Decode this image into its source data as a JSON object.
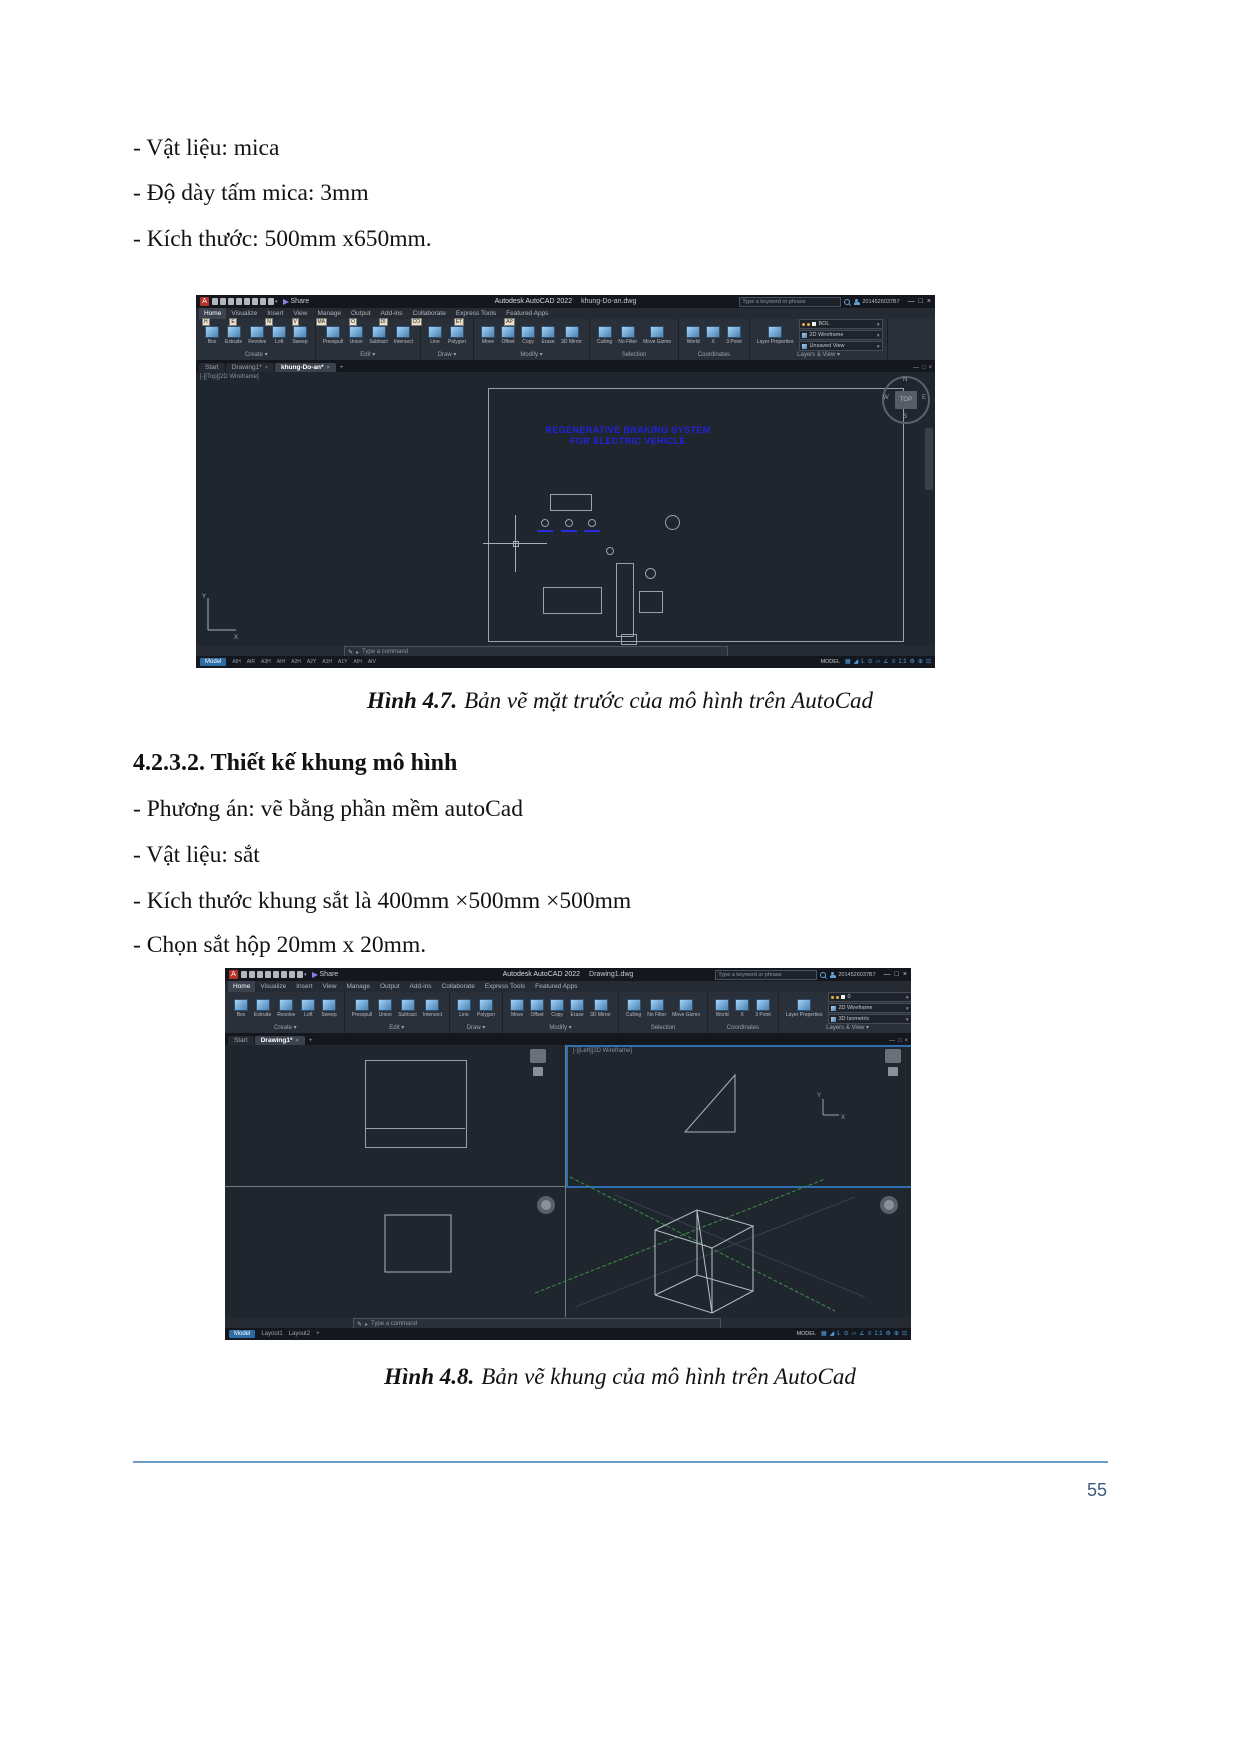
{
  "doc": {
    "bullets_top": [
      "- Vật liệu: mica",
      "- Độ dày tấm mica: 3mm",
      "- Kích thước: 500mm x650mm."
    ],
    "caption1_label": "Hình 4.7.",
    "caption1_text": "Bản vẽ mặt trước của mô hình trên AutoCad",
    "heading": "4.2.3.2. Thiết kế khung mô hình",
    "bullets_mid": [
      "- Phương án: vẽ bằng phần mềm autoCad",
      "- Vật liệu: sắt",
      "- Kích thước khung sắt là 400mm ×500mm ×500mm",
      "- Chọn sắt hộp 20mm x 20mm."
    ],
    "caption2_label": "Hình 4.8.",
    "caption2_text": "Bản vẽ khung của mô hình trên AutoCad",
    "page_number": "55"
  },
  "ribbon": {
    "tabs": [
      {
        "label": "Home",
        "keytip": "H"
      },
      {
        "label": "Visualize",
        "keytip": "E"
      },
      {
        "label": "Insert",
        "keytip": "N"
      },
      {
        "label": "View",
        "keytip": "V"
      },
      {
        "label": "Manage",
        "keytip": "MA"
      },
      {
        "label": "Output",
        "keytip": "O"
      },
      {
        "label": "Add-ins",
        "keytip": "DI"
      },
      {
        "label": "Collaborate",
        "keytip": "CO"
      },
      {
        "label": "Express Tools",
        "keytip": "ET"
      },
      {
        "label": "Featured Apps",
        "keytip": "AP"
      }
    ],
    "panels": [
      {
        "name": "Create ▾",
        "tools": [
          "Box",
          "Extrude",
          "Revolve",
          "Loft",
          "Sweep"
        ]
      },
      {
        "name": "Edit ▾",
        "tools": [
          "Presspull",
          "Union",
          "Subtract",
          "Intersect"
        ]
      },
      {
        "name": "Draw ▾",
        "tools": [
          "Line",
          "Polygon"
        ]
      },
      {
        "name": "Modify ▾",
        "tools": [
          "Move",
          "Offset",
          "Copy",
          "Erase",
          "3D Mirror"
        ]
      },
      {
        "name": "Selection",
        "tools": [
          "Culling",
          "No Filter",
          "Move Gizmo"
        ]
      },
      {
        "name": "Coordinates",
        "tools": [
          "World",
          "X",
          "3 Point"
        ]
      },
      {
        "name": "Layers & View ▾",
        "tools": [
          "Layer Properties"
        ]
      }
    ]
  },
  "qat_icons": [
    {
      "name": "new-file-icon"
    },
    {
      "name": "open-file-icon"
    },
    {
      "name": "save-icon"
    },
    {
      "name": "save-as-icon"
    },
    {
      "name": "plot-icon"
    },
    {
      "name": "undo-icon"
    },
    {
      "name": "redo-icon"
    },
    {
      "name": "workspace-icon"
    }
  ],
  "status_icons": [
    {
      "name": "grid-icon",
      "glyph": "▦"
    },
    {
      "name": "snap-icon",
      "glyph": "◢"
    },
    {
      "name": "ortho-icon",
      "glyph": "L"
    },
    {
      "name": "polar-tracking-icon",
      "glyph": "⊙"
    },
    {
      "name": "isodraft-icon",
      "glyph": "▱"
    },
    {
      "name": "osnap-icon",
      "glyph": "∠"
    },
    {
      "name": "lineweight-icon",
      "glyph": "≡"
    },
    {
      "name": "annotation-scale-icon",
      "glyph": "1:1"
    },
    {
      "name": "workspace-gear-icon",
      "glyph": "⚙"
    },
    {
      "name": "annotation-monitor-icon",
      "glyph": "⊕"
    },
    {
      "name": "clean-screen-icon",
      "glyph": "⊡"
    }
  ],
  "acad1": {
    "window_title": "Autodesk AutoCAD 2022",
    "file_name": "khung-Do-an.dwg",
    "share_label": "Share",
    "search_placeholder": "Type a keyword or phrase",
    "account_id": "2014526037B7",
    "layer_value": "BOL",
    "visual_style_value": "2D Wireframe",
    "view_value": "Unsaved View",
    "file_tabs": [
      "Start",
      "Drawing1*",
      "khung-Do-an*"
    ],
    "new_tab_label": "+",
    "viewport_label": "[-][Top][2D Wireframe]",
    "drawing_title_line1": "REGENERATIVE BRAKING SYSTEM",
    "drawing_title_line2": "FOR ELECTRIC VEHICLE",
    "command_placeholder": "Type a command",
    "model_tab": "Model",
    "layout_tabs": [
      "AIH",
      "AIR",
      "A3H",
      "AIH",
      "A2H",
      "A2Y",
      "A1H",
      "A1Y",
      "AIH",
      "AIV"
    ],
    "status_right_label": "MODEL",
    "compass_n": "N",
    "compass_s": "S",
    "compass_e": "E",
    "compass_w": "W",
    "compass_top": "TOP",
    "ucs_x": "X",
    "ucs_y": "Y"
  },
  "acad2": {
    "window_title": "Autodesk AutoCAD 2022",
    "file_name": "Drawing1.dwg",
    "share_label": "Share",
    "search_placeholder": "Type a keyword or phrase",
    "account_id": "2014526037B7",
    "layer_value": "0",
    "visual_style_value": "2D Wireframe",
    "view_value": "3D Isometric",
    "file_tabs": [
      "Start",
      "Drawing1*"
    ],
    "new_tab_label": "+",
    "viewport_label": "[-][Left][2D Wireframe]",
    "command_placeholder": "Type a command",
    "model_tab": "Model",
    "layout_tabs": [
      "Layout1",
      "Layout2"
    ],
    "new_layout_label": "+",
    "status_right_label": "MODEL",
    "ucs_x": "X",
    "ucs_y": "Y"
  }
}
